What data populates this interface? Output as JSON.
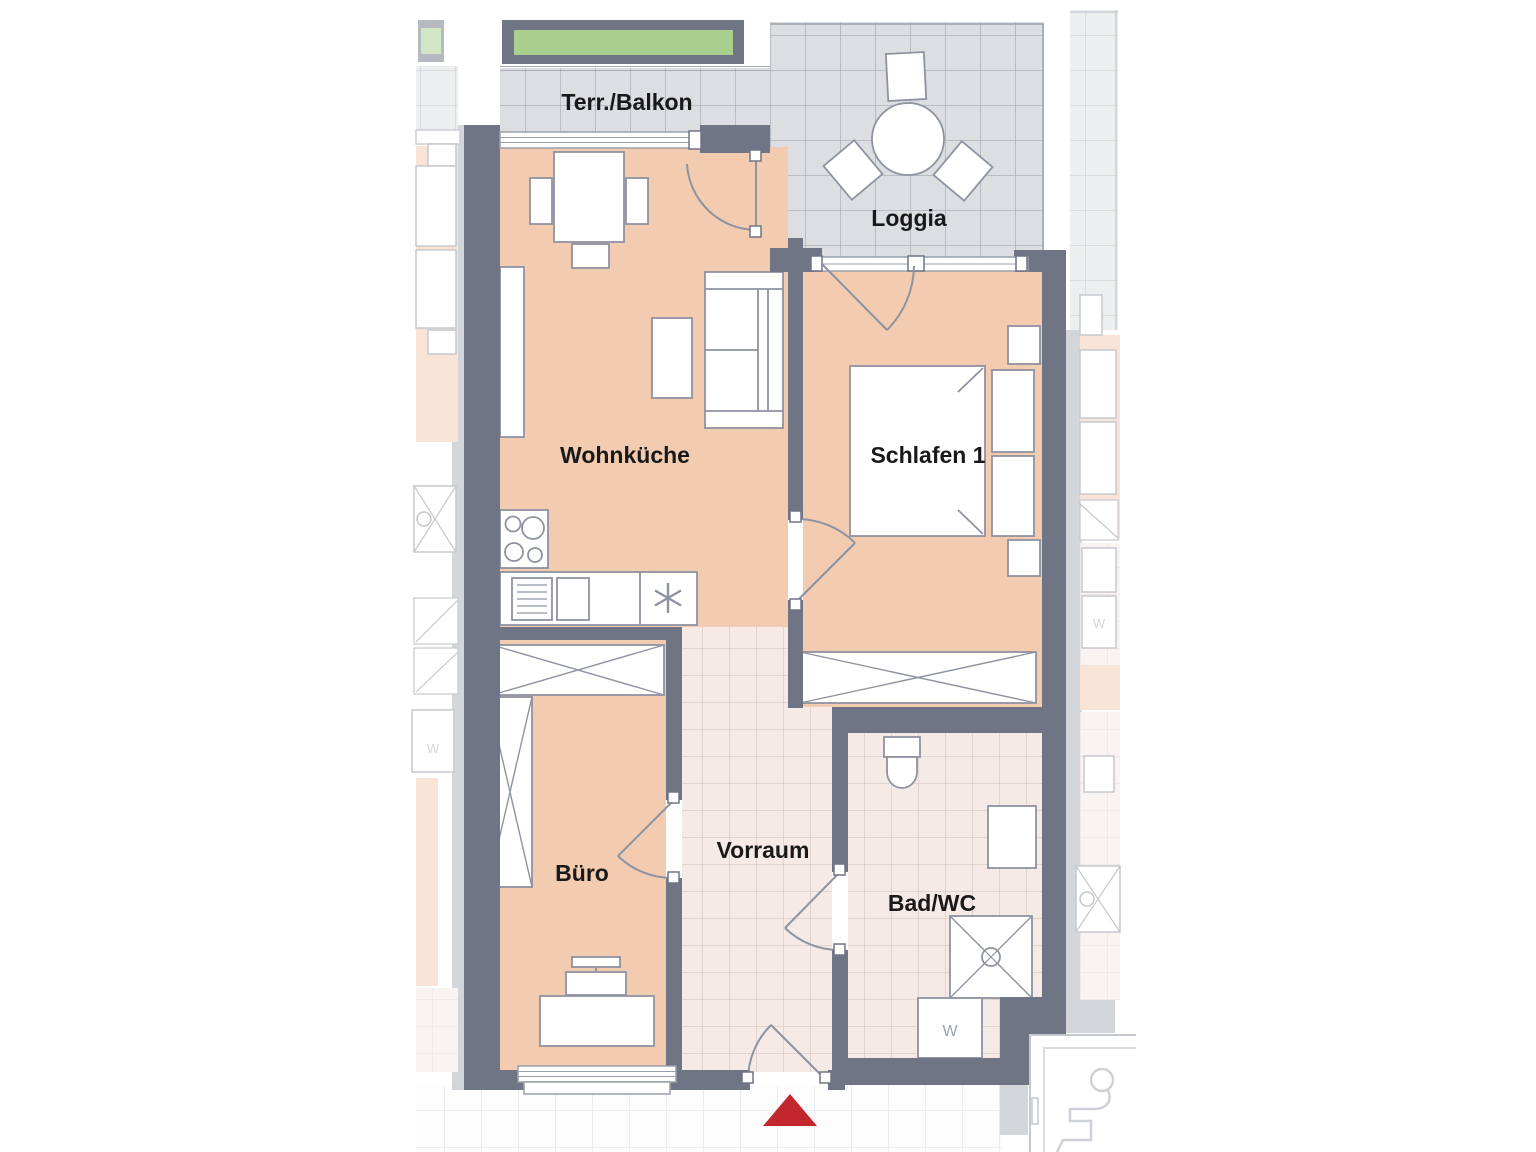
{
  "page": {
    "type": "apartment-floor-plan"
  },
  "rooms": {
    "terrace": {
      "label": "Terr./Balkon"
    },
    "loggia": {
      "label": "Loggia"
    },
    "living_kitchen": {
      "label": "Wohnküche"
    },
    "bedroom_1": {
      "label": "Schlafen 1"
    },
    "office": {
      "label": "Büro"
    },
    "hallway": {
      "label": "Vorraum"
    },
    "bathroom": {
      "label": "Bad/WC"
    }
  },
  "appliances": {
    "washer_main": "W",
    "washer_left_unit": "W",
    "washer_right_unit": "W"
  },
  "colors": {
    "wall": "#6f7585",
    "wall_faded": "#a9aeb8",
    "room_fill": "#f2cbb0",
    "room_fill_faded": "#f8e7d9",
    "terrace_tile": "#dcdee2",
    "terrace_tile_line": "#acb0ba",
    "hallway_tile": "#f5eae5",
    "hallway_tile_line": "#d6c8c2",
    "corridor_tile_line": "#e7e8ec",
    "planter_green": "#a9cf8e",
    "entrance_marker": "#c1272d",
    "furniture_outline": "#8e93a1",
    "label_text": "#191919"
  }
}
